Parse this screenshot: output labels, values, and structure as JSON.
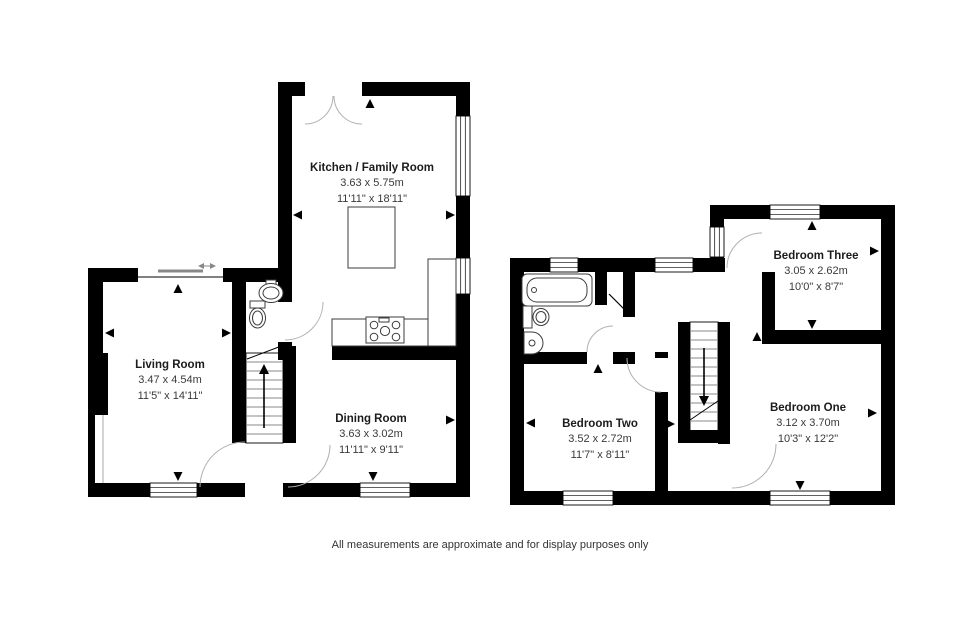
{
  "title": "Floor plan",
  "floors": {
    "ground": {
      "rooms": {
        "kitchen": {
          "name": "Kitchen / Family Room",
          "metric": "3.63 x 5.75m",
          "imperial": "11'11\" x 18'11\""
        },
        "living": {
          "name": "Living Room",
          "metric": "3.47 x 4.54m",
          "imperial": "11'5\" x 14'11\""
        },
        "dining": {
          "name": "Dining Room",
          "metric": "3.63 x 3.02m",
          "imperial": "11'11\" x 9'11\""
        }
      }
    },
    "first": {
      "rooms": {
        "bedroom_three": {
          "name": "Bedroom Three",
          "metric": "3.05 x 2.62m",
          "imperial": "10'0\" x 8'7\""
        },
        "bedroom_two": {
          "name": "Bedroom Two",
          "metric": "3.52 x 2.72m",
          "imperial": "11'7\" x 8'11\""
        },
        "bedroom_one": {
          "name": "Bedroom One",
          "metric": "3.12 x 3.70m",
          "imperial": "10'3\" x 12'2\""
        }
      }
    }
  },
  "footer": {
    "disclaimer": "All measurements are approximate and for display purposes only"
  },
  "colors": {
    "wall": "#000000",
    "fixture": "#3c3c3c",
    "door_arc": "#b0b0b0",
    "stair_tread": "#8a8a8a",
    "background": "#ffffff"
  }
}
